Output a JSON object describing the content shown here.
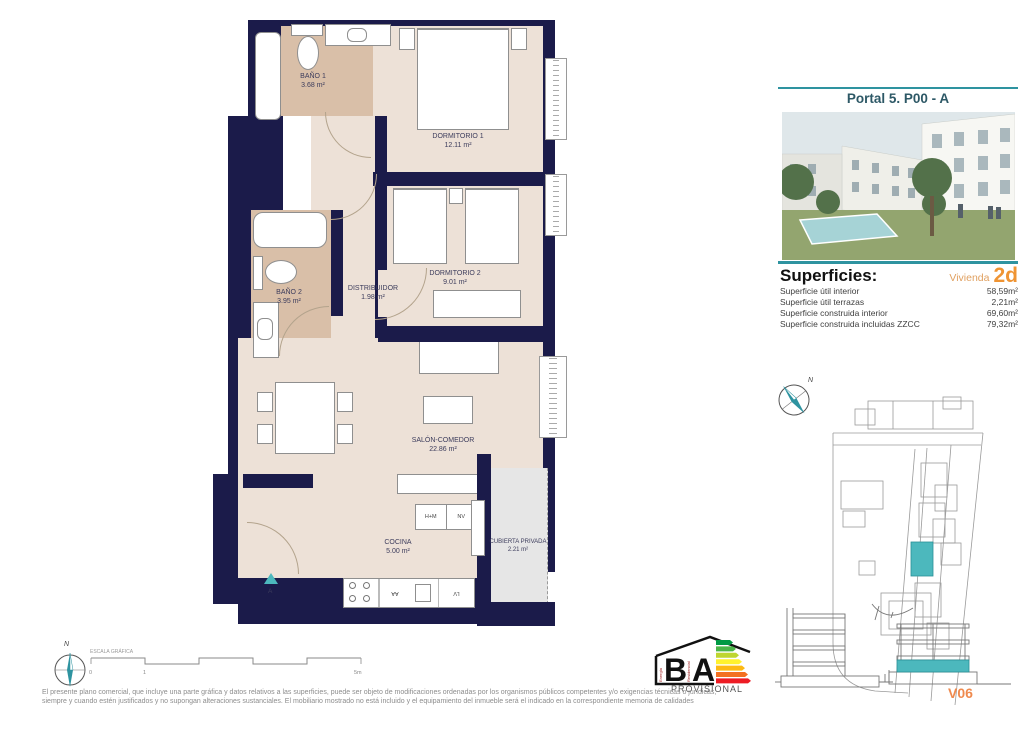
{
  "header": {
    "title": "Portal 5. P00 - A"
  },
  "superficies": {
    "heading": "Superficies:",
    "vivienda_label": "Vivienda",
    "vivienda_code": "2d",
    "rows": [
      {
        "label": "Superficie útil interior",
        "value": "58,59m²"
      },
      {
        "label": "Superficie útil terrazas",
        "value": "2,21m²"
      },
      {
        "label": "Superficie construida interior",
        "value": "69,60m²"
      },
      {
        "label": "Superficie construida incluidas ZZCC",
        "value": "79,32m²"
      }
    ]
  },
  "plan": {
    "rooms": [
      {
        "name": "BAÑO 1",
        "area": "3.68 m²"
      },
      {
        "name": "DORMITORIO 1",
        "area": "12.11 m²"
      },
      {
        "name": "DORMITORIO 2",
        "area": "9.01 m²"
      },
      {
        "name": "BAÑO 2",
        "area": "3.95 m²"
      },
      {
        "name": "DISTRIBUIDOR",
        "area": "1.98 m²"
      },
      {
        "name": "SALÓN-COMEDOR",
        "area": "22.86 m²"
      },
      {
        "name": "COCINA",
        "area": "5.00 m²"
      },
      {
        "name": "CUBIERTA PRIVADA",
        "area": "2.21 m²"
      }
    ],
    "kitchen_units": {
      "oven_micro": "H+M",
      "fridge": "NV",
      "washer": "AA",
      "dishwasher": "LV"
    },
    "entrance_label": "A"
  },
  "scale_bar": {
    "label": "ESCALA GRÁFICA",
    "tick_start": "0",
    "tick_one": "1",
    "tick_end": "5m"
  },
  "compass": {
    "north": "N"
  },
  "energy_logo": {
    "letter_b": "B",
    "letter_a": "A",
    "vertical_left": "Energía",
    "vertical_right": "Residencial",
    "status": "PROVISIONAL"
  },
  "footer": {
    "disclaimer_line1": "El presente plano comercial, que incluye una parte gráfica y datos relativos a las superficies, puede ser objeto de modificaciones ordenadas por los organismos públicos competentes y/o exigencias técnicas o jurídicas,",
    "disclaimer_line2": "siempre y cuando estén justificados y no supongan alteraciones sustanciales. El mobiliario mostrado no está incluido y el equipamiento del inmueble será el indicado en la correspondiente memoria de calidades"
  },
  "version_tag": "V06",
  "colors": {
    "wall": "#1b1b4a",
    "beige": "#ede1d7",
    "tan": "#d9bfa8",
    "teal": "#2e93a0",
    "hteal": "#4cb8bd",
    "orange": "#ef9433",
    "title": "#2d5866"
  }
}
